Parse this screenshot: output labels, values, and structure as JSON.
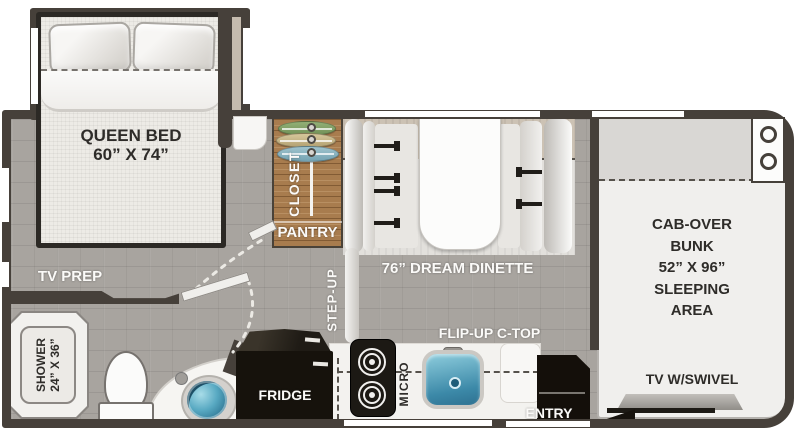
{
  "floorplan": {
    "bedroom": {
      "bed_name": "QUEEN BED",
      "bed_size": "60” X 74”",
      "tv_prep": "TV PREP"
    },
    "closet": {
      "closet": "CLOSET",
      "pantry": "PANTRY"
    },
    "dinette": {
      "label": "76” DREAM DINETTE"
    },
    "kitchen": {
      "flip_up_ctop": "FLIP-UP C-TOP",
      "fridge": "FRIDGE",
      "micro": "MICRO",
      "step_up": "STEP-UP"
    },
    "entry": {
      "label": "ENTRY"
    },
    "bathroom": {
      "shower": "SHOWER",
      "shower_size": "24” X 36”"
    },
    "cab": {
      "bunk_lines": [
        "CAB-OVER",
        "BUNK",
        "52” X 96”",
        "SLEEPING",
        "AREA"
      ],
      "tv": "TV W/SWIVEL"
    },
    "items": [
      "queen-bed",
      "pillows",
      "clothes-hangers",
      "closet-rod",
      "dinette-table",
      "dinette-benches",
      "seat-belts",
      "fridge",
      "cooktop-burners",
      "kitchen-sink",
      "entry-steps",
      "shower-stall",
      "toilet",
      "vanity-sink",
      "cab-over-bunk",
      "cup-holders",
      "tv-with-swivel",
      "interior-doors"
    ],
    "colors": {
      "wall": "#46403a",
      "floor": "#a8a49f",
      "closet_wood": "#a87c4e",
      "sink_teal": "#4a9cba",
      "appliance_black": "#16120d",
      "label_white": "#fbfaf8",
      "label_dark": "#2e2c29"
    }
  }
}
